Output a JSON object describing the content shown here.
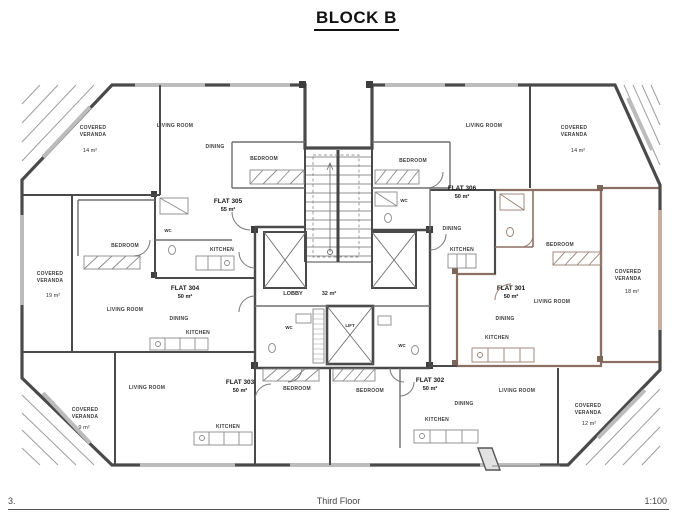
{
  "title": "BLOCK B",
  "footer": {
    "sheet_number": "3.",
    "floor_label": "Third Floor",
    "scale": "1:100"
  },
  "colors": {
    "wall": "#4a4a4a",
    "highlight_fill": "#f6dcce",
    "highlight_wall": "#8b6f62",
    "hatch": "#9f9f9f",
    "window": "#bcbcbc"
  },
  "core": {
    "lobby_label": "LOBBY",
    "lobby_area": "32 m²",
    "lift_label": "LIFT",
    "wc_left_label": "WC",
    "wc_right_label": "WC"
  },
  "flats": [
    {
      "label": "FLAT 301",
      "area": "50 m²",
      "highlighted": true,
      "rooms": {
        "bedroom": "BEDROOM",
        "living": "LIVING ROOM",
        "dining": "DINING",
        "kitchen": "KITCHEN"
      },
      "veranda": {
        "line1": "COVERED",
        "line2": "VERANDA",
        "area": "18 m²"
      }
    },
    {
      "label": "FLAT 302",
      "area": "50 m²",
      "highlighted": false,
      "rooms": {
        "bedroom": "BEDROOM",
        "dining": "DINING",
        "kitchen": "KITCHEN",
        "living": "LIVING ROOM"
      },
      "veranda": {
        "line1": "COVERED",
        "line2": "VERANDA",
        "area": "12 m²"
      }
    },
    {
      "label": "FLAT 303",
      "area": "50 m²",
      "highlighted": false,
      "rooms": {
        "living": "LIVING ROOM",
        "bedroom": "BEDROOM",
        "kitchen": "KITCHEN"
      },
      "veranda": {
        "line1": "COVERED",
        "line2": "VERANDA",
        "area": "9 m²"
      }
    },
    {
      "label": "FLAT 304",
      "area": "50 m²",
      "highlighted": false,
      "rooms": {
        "bedroom": "BEDROOM",
        "living": "LIVING ROOM",
        "dining": "DINING",
        "kitchen": "KITCHEN"
      },
      "veranda": {
        "line1": "COVERED",
        "line2": "VERANDA",
        "area": "19 m²"
      }
    },
    {
      "label": "FLAT 305",
      "area": "55 m²",
      "highlighted": false,
      "rooms": {
        "living": "LIVING ROOM",
        "dining": "DINING",
        "bedroom": "BEDROOM",
        "kitchen": "KITCHEN",
        "wc": "WC"
      },
      "veranda": {
        "line1": "COVERED",
        "line2": "VERANDA",
        "area": "14 m²"
      }
    },
    {
      "label": "FLAT 306",
      "area": "50 m²",
      "highlighted": false,
      "rooms": {
        "living": "LIVING ROOM",
        "bedroom": "BEDROOM",
        "dining": "DINING",
        "kitchen": "KITCHEN",
        "wc": "WC"
      },
      "veranda": {
        "line1": "COVERED",
        "line2": "VERANDA",
        "area": "14 m²"
      }
    }
  ]
}
